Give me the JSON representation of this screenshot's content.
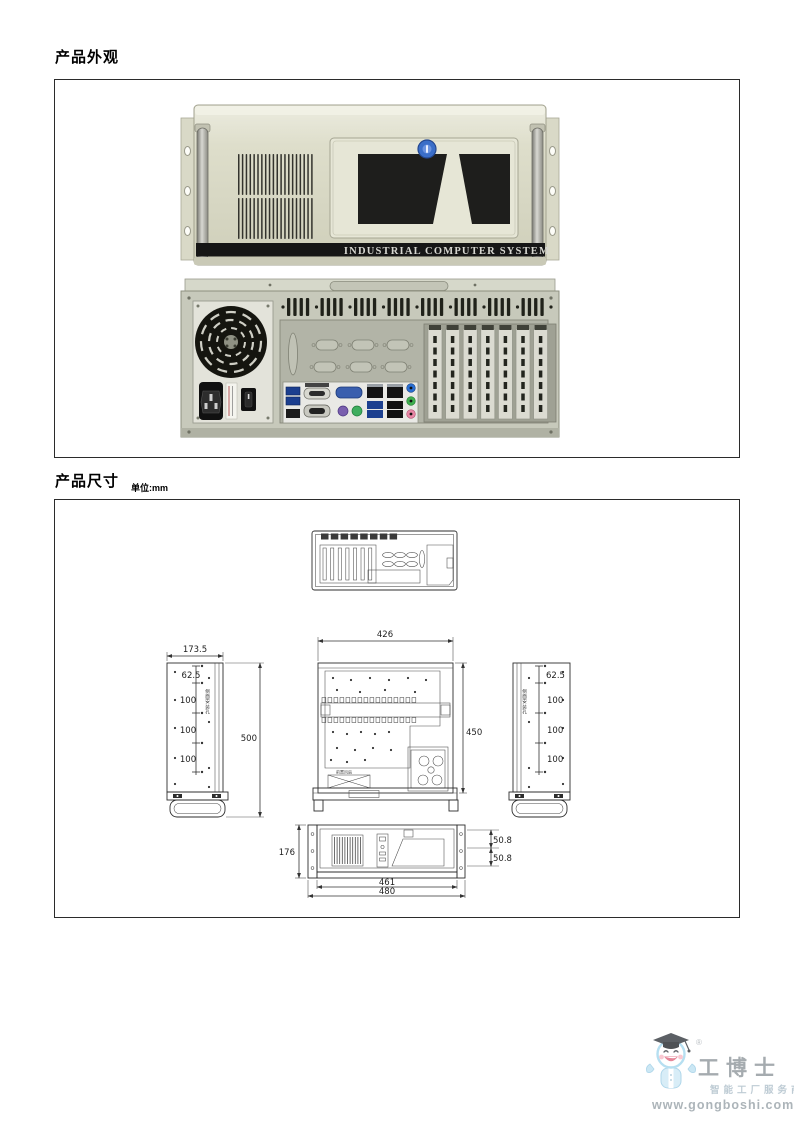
{
  "sections": {
    "appearance_title": "产品外观",
    "dimensions_title": "产品尺寸",
    "unit_label": "单位:mm"
  },
  "front_photo": {
    "brand_text": "INDUSTRIAL COMPUTER SYSTEM"
  },
  "drawing": {
    "left_side": {
      "width": "173.5",
      "height": "500",
      "offsets": [
        "62.5",
        "100",
        "100",
        "100"
      ],
      "holes_label": "侧面安装孔"
    },
    "right_side": {
      "offsets": [
        "62.5",
        "100",
        "100",
        "100"
      ],
      "holes_label": "侧面安装孔"
    },
    "top_view": {
      "width": "426",
      "depth": "450",
      "fan_label": "前置风扇"
    },
    "front_view": {
      "height": "176",
      "unit1": "50.8",
      "unit2": "50.8",
      "width_inner": "461",
      "width_outer": "480"
    }
  },
  "logo": {
    "name": "工博士",
    "reg": "®",
    "tagline": "智能工厂服务商",
    "website": "www.gongboshi.com"
  },
  "colors": {
    "chassis_beige": "#dedecb",
    "chassis_rear": "#c7c9bb",
    "lock_blue": "#3a6ec8",
    "stripe_black": "#161616",
    "line": "#333333"
  }
}
